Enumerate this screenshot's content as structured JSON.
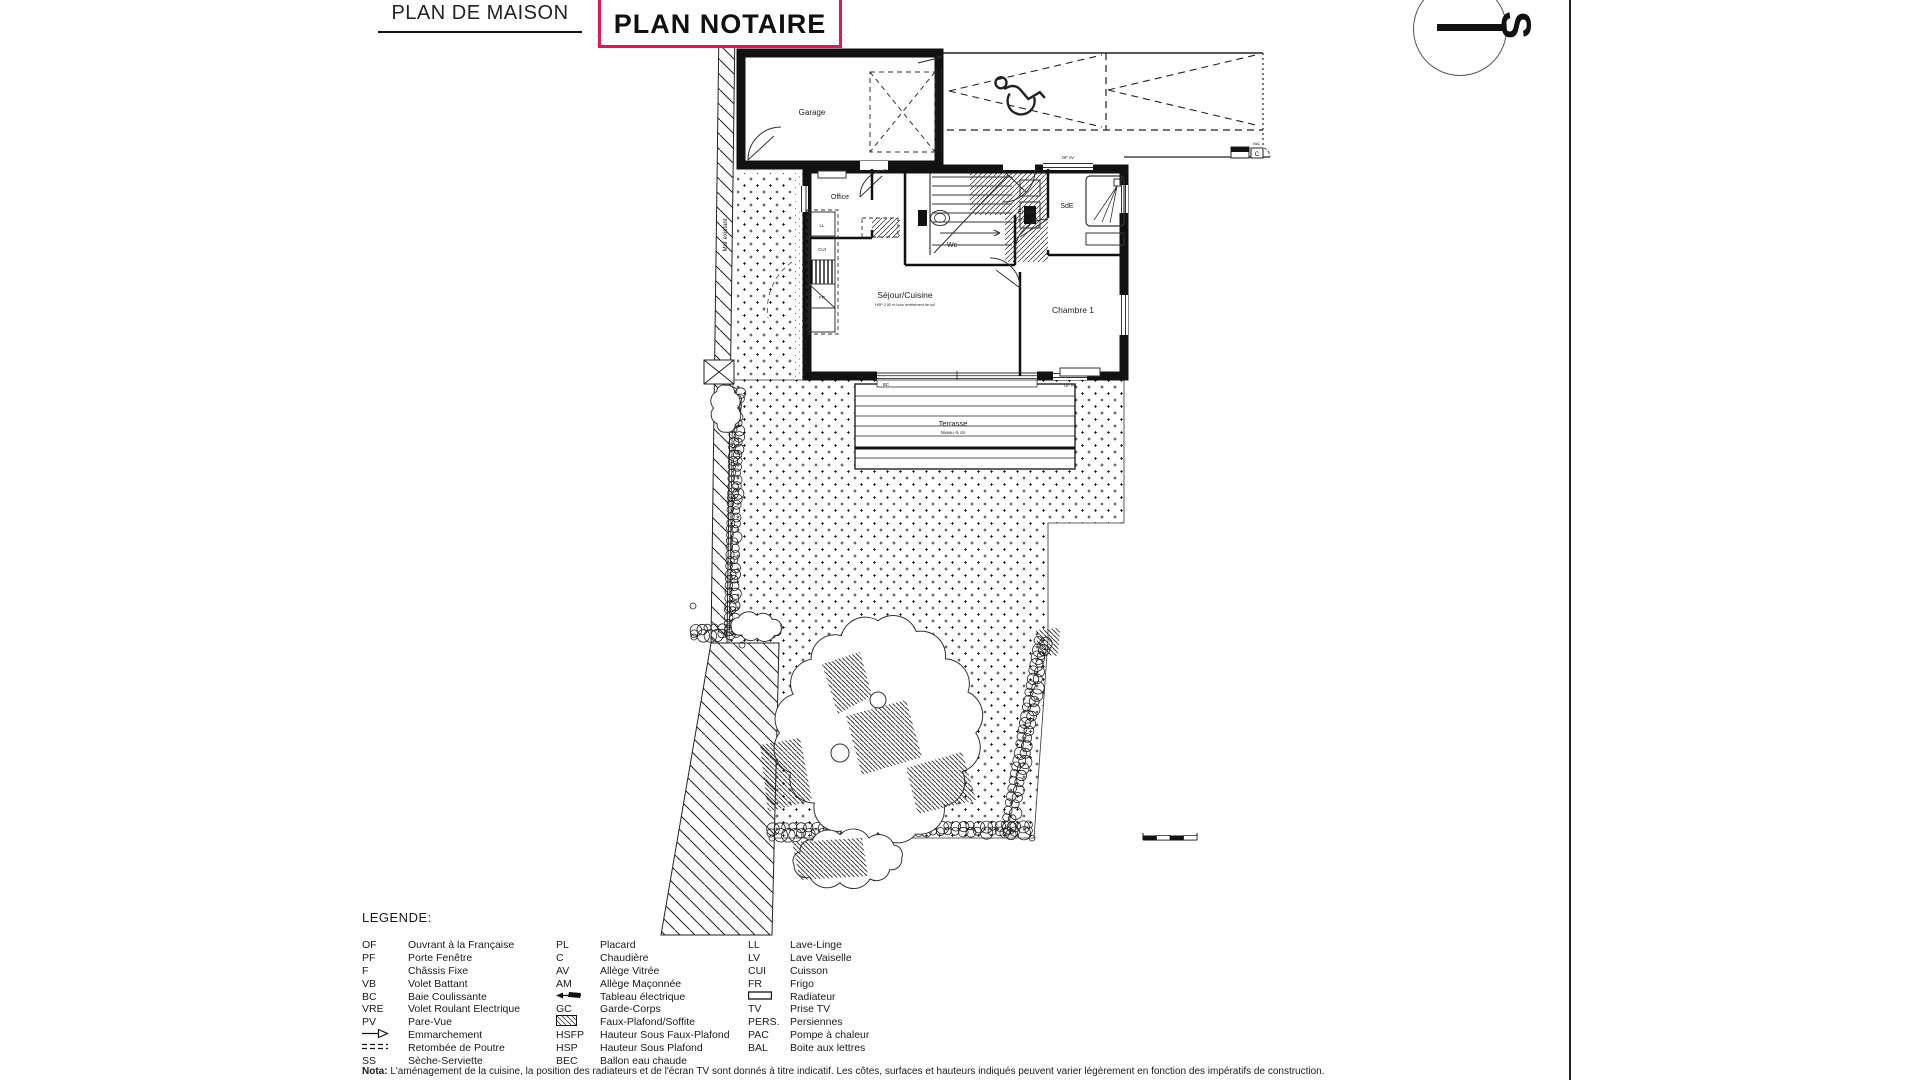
{
  "header": {
    "doc_title": "PLAN DE MAISON",
    "stamp": "PLAN NOTAIRE",
    "stamp_color": "#e8134f"
  },
  "compass": {
    "letter": "S"
  },
  "plan": {
    "rooms": {
      "garage": "Garage",
      "office": "Office",
      "wc": "Wc",
      "entree": "Entrée",
      "entree_sub": "HSFP 2.20 m",
      "sde": "SdE",
      "sejour": "Séjour/Cuisine",
      "sejour_sub": "HSP 2.50 m hors revêtement de sol",
      "chambre": "Chambre 1",
      "terrasse": "Terrasse",
      "terrasse_sub": "Niveau -5 cm"
    },
    "kitchen": {
      "ll": "LL",
      "cui": "CUI",
      "fr": "FR"
    },
    "openings": {
      "bay_label": "BC",
      "north_window_label": "OF AV",
      "chambre_window_label": "OF AV"
    },
    "site": {
      "existing_wall_label": "Mur existant",
      "mailbox_label": "BAL",
      "mailbox_letter": "C"
    }
  },
  "legend": {
    "title": "LEGENDE:",
    "columns": [
      [
        {
          "abbr": "OF",
          "label": "Ouvrant à la Française"
        },
        {
          "abbr": "PF",
          "label": "Porte Fenêtre"
        },
        {
          "abbr": "F",
          "label": "Châssis Fixe"
        },
        {
          "abbr": "VB",
          "label": "Volet Battant"
        },
        {
          "abbr": "BC",
          "label": "Baie Coulissante"
        },
        {
          "abbr": "VRE",
          "label": "Volet Roulant Electrique"
        },
        {
          "abbr": "PV",
          "label": "Pare-Vue"
        },
        {
          "icon": "emmarchement-icon",
          "label": "Emmarchement"
        },
        {
          "icon": "retombee-icon",
          "label": "Retombée de Poutre"
        },
        {
          "abbr": "SS",
          "label": "Sèche-Serviette"
        }
      ],
      [
        {
          "abbr": "PL",
          "label": "Placard"
        },
        {
          "abbr": "C",
          "label": "Chaudière"
        },
        {
          "abbr": "AV",
          "label": "Allège Vitrée"
        },
        {
          "abbr": "AM",
          "label": "Allège Maçonnée"
        },
        {
          "icon": "tableau-icon",
          "label": "Tableau électrique"
        },
        {
          "abbr": "GC",
          "label": "Garde-Corps"
        },
        {
          "icon": "fauxplafond-icon",
          "label": "Faux-Plafond/Soffite"
        },
        {
          "abbr": "HSFP",
          "label": "Hauteur Sous Faux-Plafond"
        },
        {
          "abbr": "HSP",
          "label": "Hauteur Sous Plafond"
        },
        {
          "abbr": "BEC",
          "label": "Ballon eau chaude"
        }
      ],
      [
        {
          "abbr": "LL",
          "label": "Lave-Linge"
        },
        {
          "abbr": "LV",
          "label": "Lave Vaiselle"
        },
        {
          "abbr": "CUI",
          "label": "Cuisson"
        },
        {
          "abbr": "FR",
          "label": "Frigo"
        },
        {
          "icon": "radiateur-icon",
          "label": "Radiateur"
        },
        {
          "abbr": "TV",
          "label": "Prise TV"
        },
        {
          "abbr": "PERS.",
          "label": "Persiennes"
        },
        {
          "abbr": "PAC",
          "label": "Pompe à chaleur"
        },
        {
          "abbr": "BAL",
          "label": "Boite aux lettres"
        }
      ]
    ]
  },
  "note": {
    "prefix": "Nota:",
    "text": " L'aménagement de la cuisine, la position des radiateurs et de l'écran TV sont donnés à titre indicatif. Les côtes, surfaces et hauteurs indiqués peuvent varier légèrement en fonction des impératifs de construction."
  }
}
